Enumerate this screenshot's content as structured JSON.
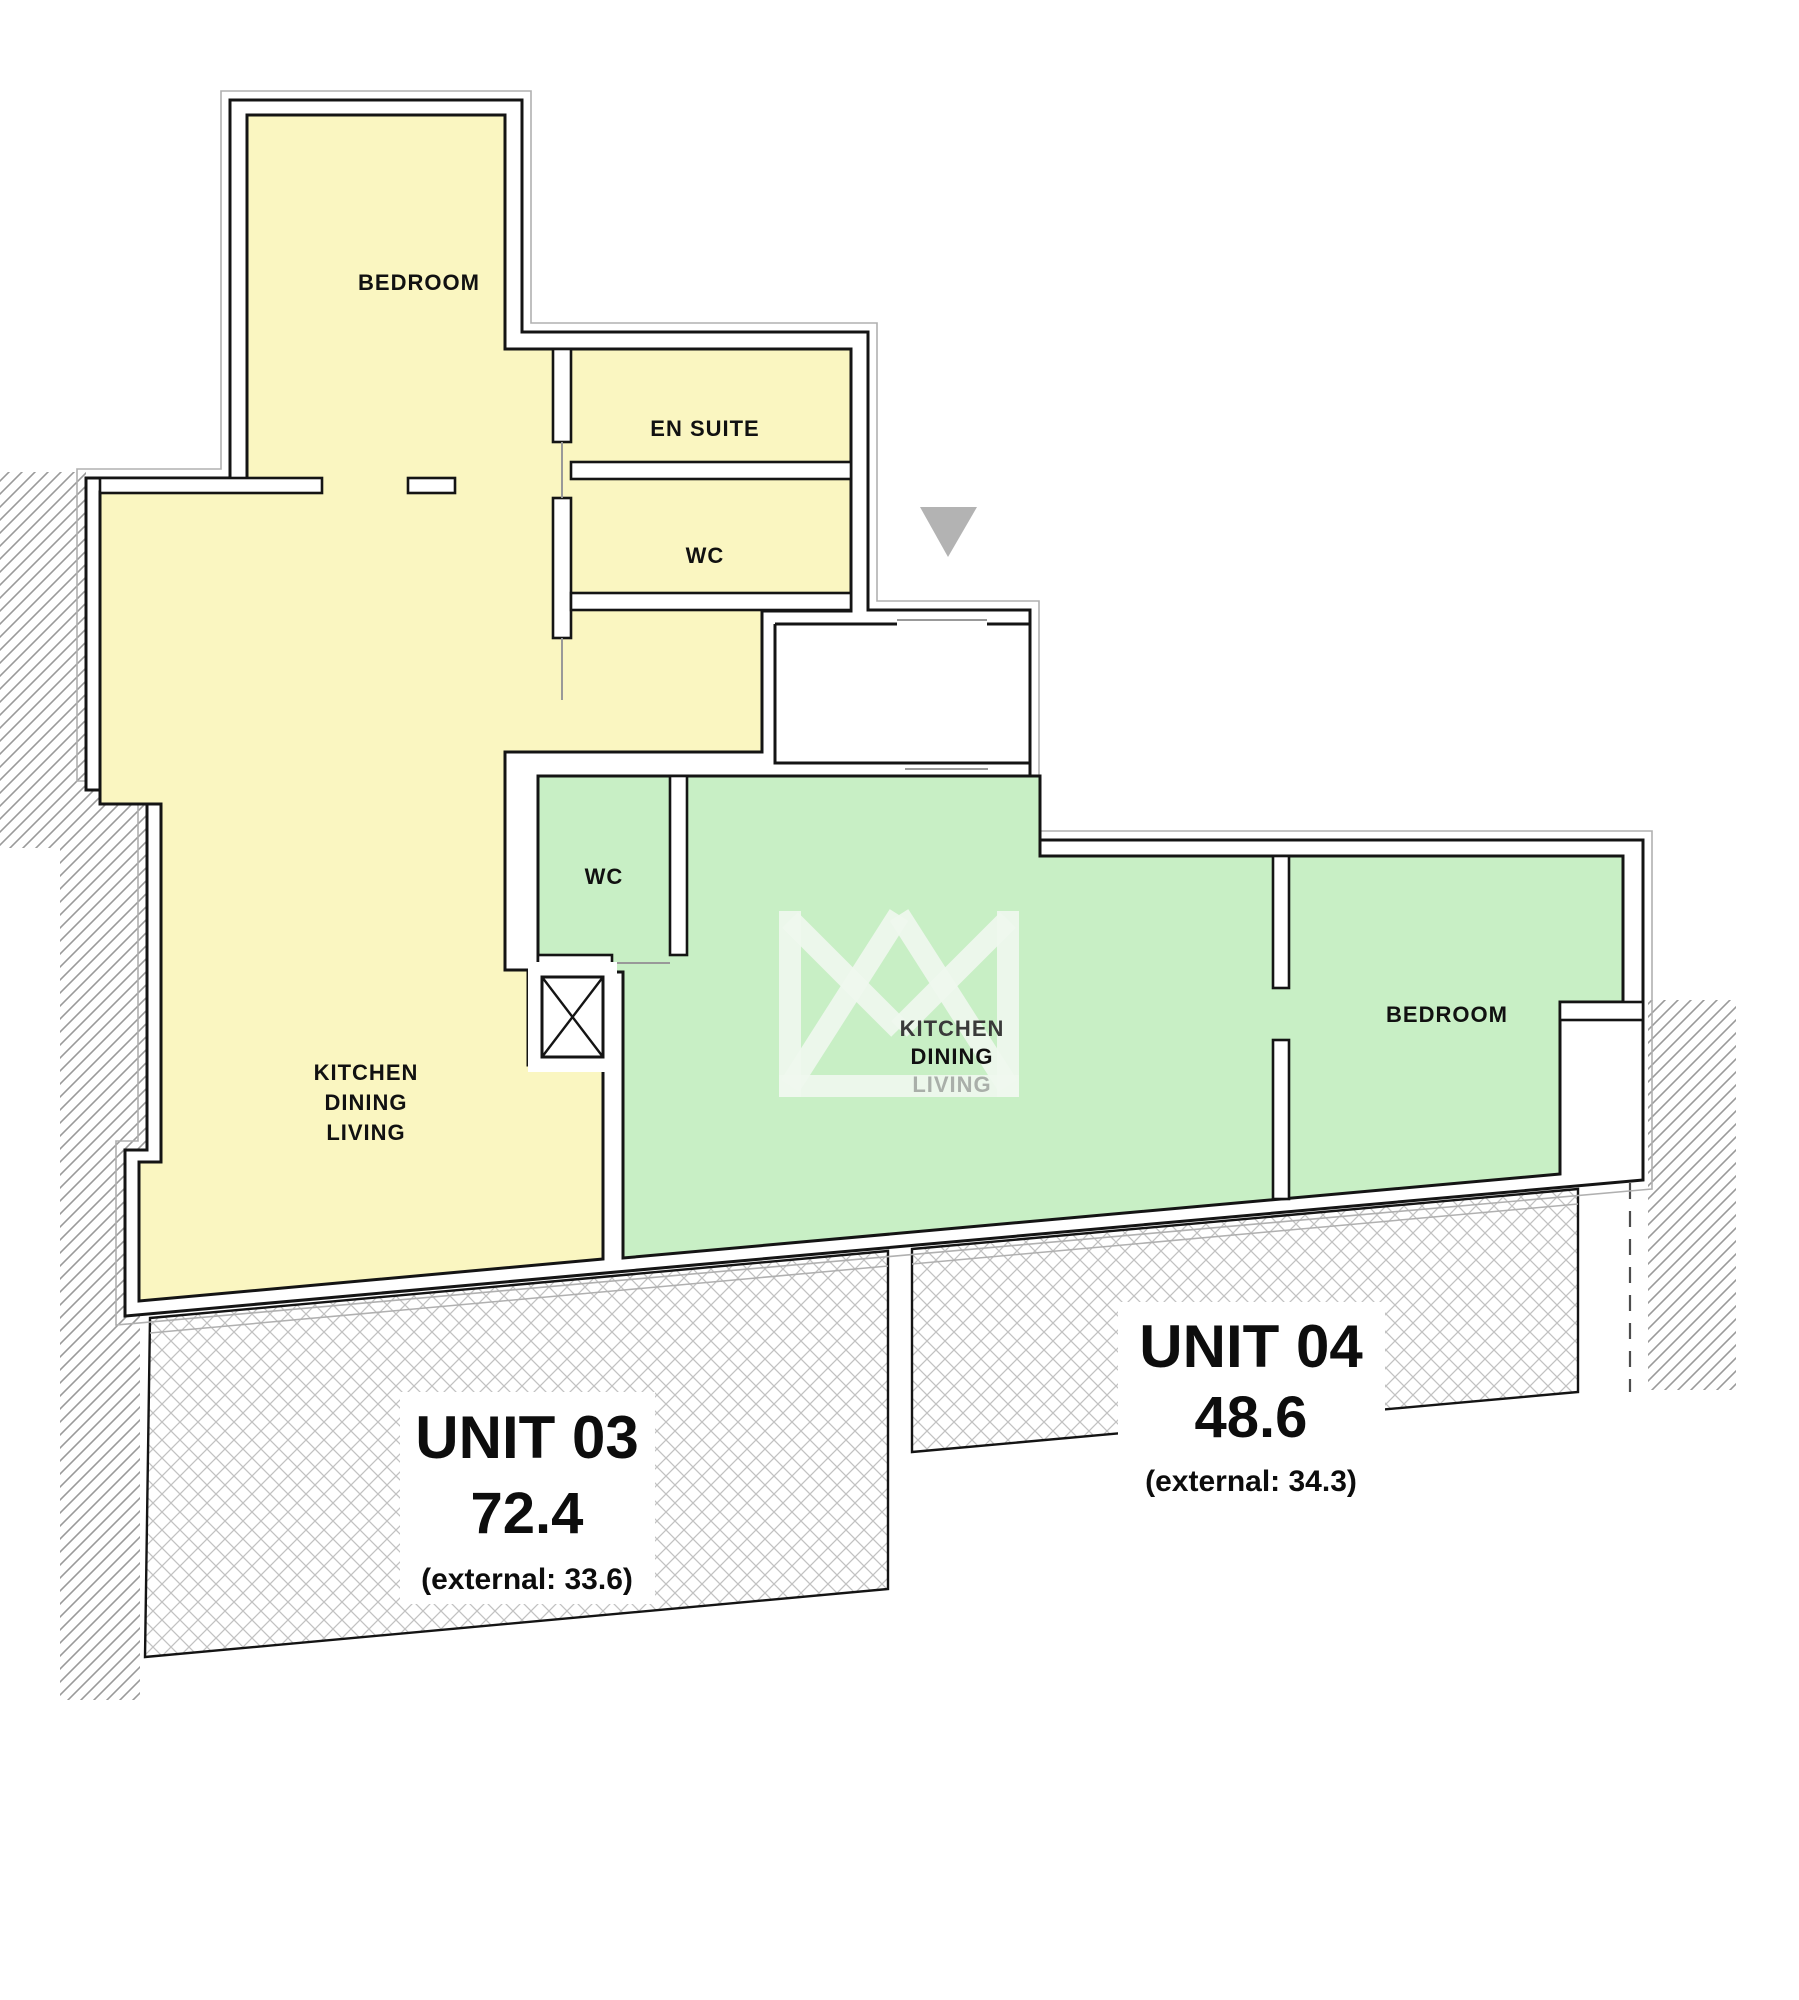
{
  "plan": {
    "unit03": {
      "label": "UNIT 03",
      "area": "72.4",
      "external": "(external: 33.6)",
      "rooms": {
        "bedroom": "BEDROOM",
        "en_suite": "EN SUITE",
        "wc": "WC",
        "kitchen": "KITCHEN",
        "dining": "DINING",
        "living": "LIVING"
      }
    },
    "unit04": {
      "label": "UNIT 04",
      "area": "48.6",
      "external": "(external: 34.3)",
      "rooms": {
        "wc": "WC",
        "kitchen": "KITCHEN",
        "dining": "DINING",
        "living": "LIVING",
        "bedroom": "BEDROOM"
      }
    }
  },
  "colors": {
    "unit03_fill": "#FAF6C1",
    "unit04_fill": "#C8EFC5",
    "wall_line": "#141414",
    "shell_fill": "#FFFFFF",
    "site_hatch_line": "#9A9A9A",
    "terrace_hatch_line": "#C2C2C2",
    "entrance_marker": "#B3B3B3",
    "door_line": "#999999",
    "outer_offset_line": "#B0B0B0",
    "dashed_boundary": "#4D4D4D",
    "watermark": "#F0F7EE",
    "faded_label": "#A9AFA9",
    "dim_label": "#3A3A3A"
  }
}
